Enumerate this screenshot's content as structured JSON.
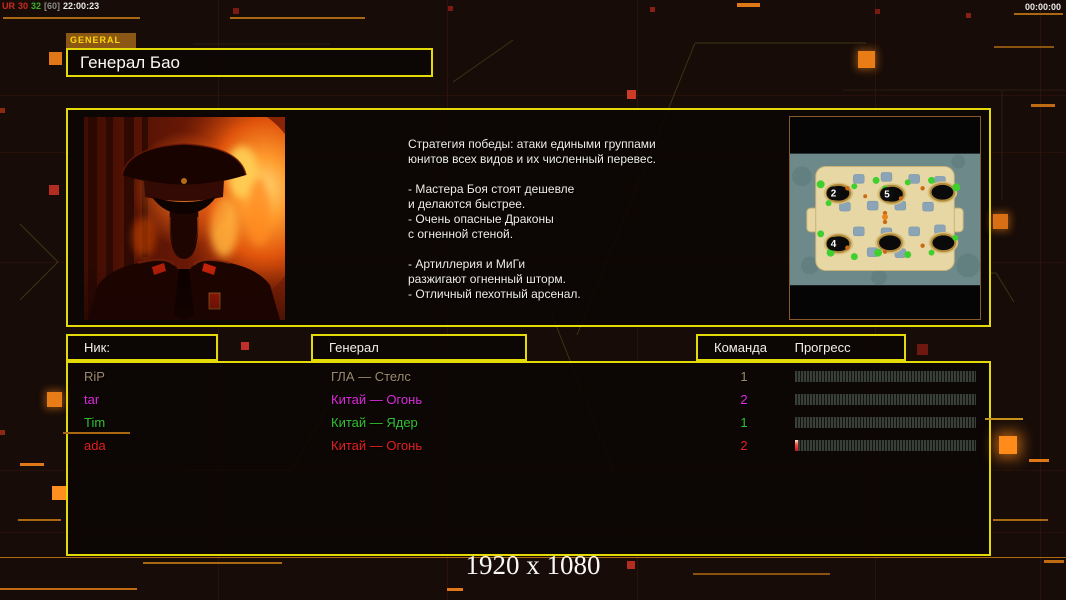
{
  "colors": {
    "accent_yellow": "#e4da08",
    "accent_orange": "#c87818",
    "player_colors": [
      "#9c8a6e",
      "#dd2add",
      "#33c133",
      "#e62020"
    ]
  },
  "top_overlay": {
    "left_stats": {
      "prefix": "UR",
      "value_a": "30",
      "value_b": "32",
      "value_c": "[60]",
      "clock": "22:00:23"
    },
    "right_timer": "00:00:00"
  },
  "header": {
    "tab_label": "GENERAL",
    "title": "Генерал Бао"
  },
  "general_info": {
    "strategy_lines": [
      "Стратегия победы: атаки едиными группами",
      "юнитов всех видов и их численный перевес.",
      "",
      "- Мастера Боя стоят дешевле",
      "и делаются быстрее.",
      "- Очень опасные Драконы",
      "с огненной стеной.",
      "",
      "- Артиллерия и МиГи",
      "разжигают огненный шторм.",
      "- Отличный пехотный арсенал."
    ]
  },
  "map_preview": {
    "start_positions": [
      "2",
      "5",
      "4"
    ]
  },
  "players_table": {
    "headers": {
      "nick": "Ник:",
      "general": "Генерал",
      "team": "Команда",
      "progress": "Прогресс"
    },
    "rows": [
      {
        "nick": "RiP",
        "general": "ГЛА — Стелс",
        "team": "1",
        "color": "#9c8a6e",
        "progress_pct": 0
      },
      {
        "nick": "tar",
        "general": "Китай — Огонь",
        "team": "2",
        "color": "#dd2add",
        "progress_pct": 0
      },
      {
        "nick": "Tim",
        "general": "Китай — Ядер",
        "team": "1",
        "color": "#33c133",
        "progress_pct": 0
      },
      {
        "nick": "ada",
        "general": "Китай — Огонь",
        "team": "2",
        "color": "#e62020",
        "progress_pct": 1.5
      }
    ]
  },
  "footer": {
    "resolution": "1920 x 1080"
  }
}
